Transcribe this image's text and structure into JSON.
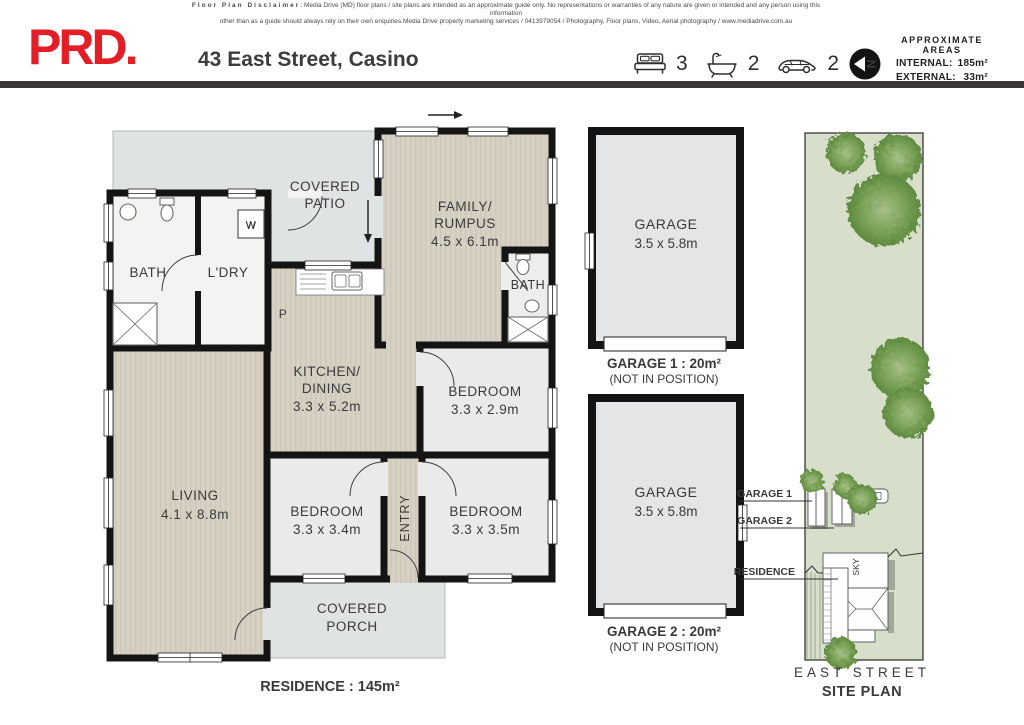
{
  "disclaimer": {
    "label": "Floor Plan Disclaimer",
    "line1": ": Media Drive (MD) floor plans / site plans are intended as an approximate guide only.  No representations or warranties of any nature are given or intended and any person using this information",
    "line2": "other than as a guide should always rely on their own enquiries.Media Drive property marketing services / 0413979054 / Photography, Floor plans,  Video, Aerial photography / www.mediadrive.com.au"
  },
  "header": {
    "logo": "PRD.",
    "title": "43 East Street, Casino",
    "beds": "3",
    "baths": "2",
    "cars": "2",
    "compass_letter": "N",
    "areas": {
      "heading1": "APPROXIMATE",
      "heading2": "AREAS",
      "internal_label": "INTERNAL:",
      "internal_value": "185m²",
      "external_label": "EXTERNAL:",
      "external_value": "33m²"
    }
  },
  "icons": {
    "bed": "bed-icon",
    "bath": "bathtub-icon",
    "car": "car-icon",
    "compass": "north-arrow-icon"
  },
  "colors": {
    "brand_red": "#e41e26",
    "bar_black": "#3a3637",
    "wall": "#141414",
    "floor_beige": "#d7d1c4",
    "room_gray": "#eaeaea",
    "patio_gray": "#e0e3e3",
    "site_green": "#d7deca",
    "tree_green": "#6b9447"
  },
  "floorplan": {
    "rooms": {
      "patio": {
        "line1": "COVERED",
        "line2": "PATIO"
      },
      "family": {
        "line1": "FAMILY/",
        "line2": "RUMPUS",
        "dims": "4.5 x 6.1m"
      },
      "bath1": {
        "name": "BATH"
      },
      "ldry": {
        "name": "L'DRY"
      },
      "washer": {
        "label": "W"
      },
      "pantry": {
        "label": "P"
      },
      "bath2": {
        "name": "BATH"
      },
      "kitchen": {
        "line1": "KITCHEN/",
        "line2": "DINING",
        "dims": "3.3 x 5.2m"
      },
      "bedroom1": {
        "name": "BEDROOM",
        "dims": "3.3 x 2.9m"
      },
      "living": {
        "name": "LIVING",
        "dims": "4.1 x 8.8m"
      },
      "bedroom2": {
        "name": "BEDROOM",
        "dims": "3.3 x 3.4m"
      },
      "entry": {
        "name": "ENTRY"
      },
      "bedroom3": {
        "name": "BEDROOM",
        "dims": "3.3 x 3.5m"
      },
      "porch": {
        "line1": "COVERED",
        "line2": "PORCH"
      }
    },
    "total": "RESIDENCE : 145m²"
  },
  "garages": {
    "garage1": {
      "name": "GARAGE",
      "dims": "3.5 x 5.8m",
      "caption": "GARAGE 1 : 20m²",
      "note": "(NOT IN POSITION)"
    },
    "garage2": {
      "name": "GARAGE",
      "dims": "3.5 x 5.8m",
      "caption": "GARAGE 2 : 20m²",
      "note": "(NOT IN POSITION)"
    }
  },
  "siteplan": {
    "garage1_label": "GARAGE 1",
    "garage2_label": "GARAGE 2",
    "residence_label": "RESIDENCE",
    "sky_label": "SKY",
    "street": "EAST STREET",
    "title": "SITE PLAN"
  }
}
